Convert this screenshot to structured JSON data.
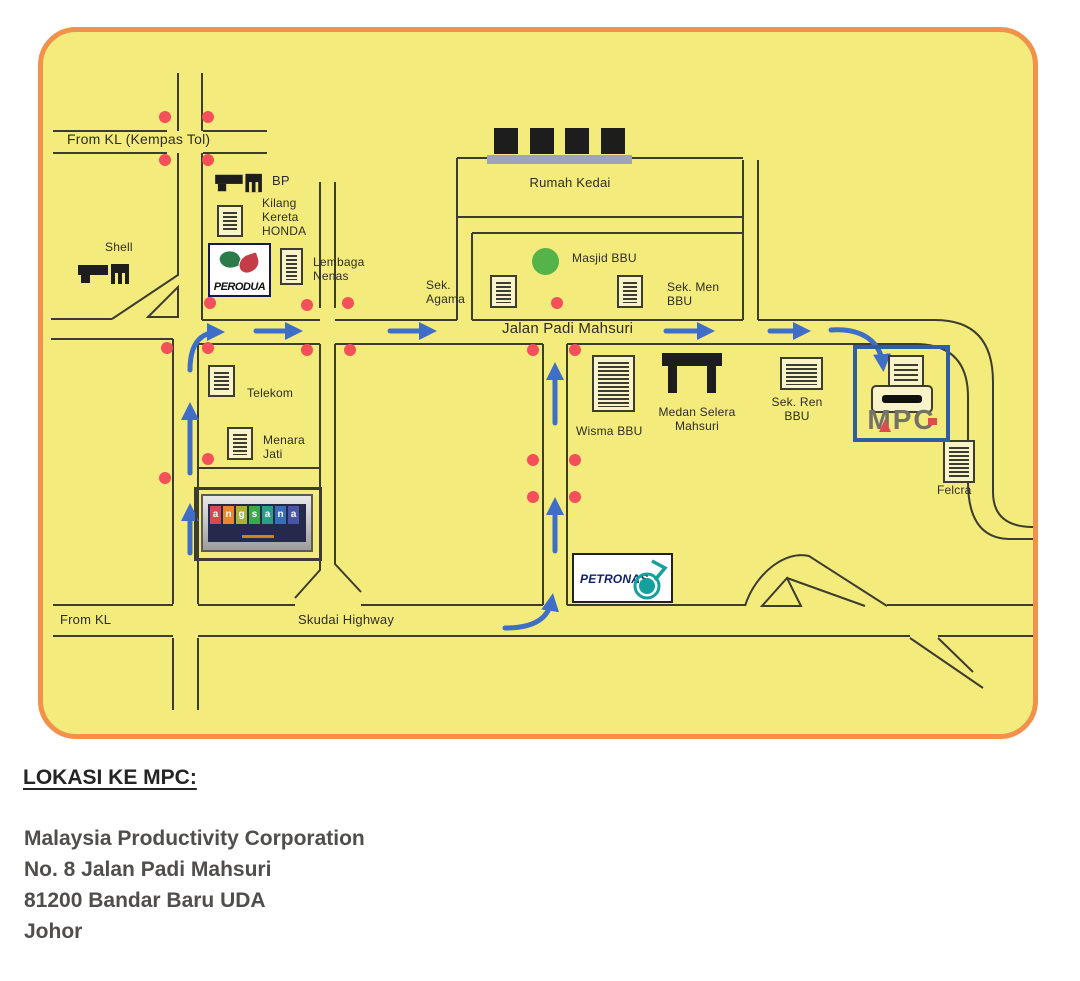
{
  "map": {
    "labels": {
      "from_kl_tol": "From KL (Kempas Tol)",
      "bp": "BP",
      "kilang_kereta_honda": "Kilang\nKereta\nHONDA",
      "shell": "Shell",
      "lembaga_nenas": "Lembaga\nNenas",
      "sek_agama": "Sek.\nAgama",
      "rumah_kedai": "Rumah Kedai",
      "masjid_bbu": "Masjid BBU",
      "sek_men_bbu": "Sek. Men\nBBU",
      "jalan_padi_mahsuri": "Jalan Padi Mahsuri",
      "telekom": "Telekom",
      "menara_jati": "Menara\nJati",
      "wisma_bbu": "Wisma BBU",
      "medan_selera_mahsuri": "Medan Selera\nMahsuri",
      "sek_ren_bbu": "Sek. Ren\nBBU",
      "felcra": "Felcra",
      "from_kl": "From KL",
      "skudai_highway": "Skudai Highway"
    },
    "logos": {
      "perodua": "PERODUA",
      "petronas": "PETRONAS",
      "mpc": "MPC",
      "angsana_letters": [
        "a",
        "n",
        "g",
        "s",
        "a",
        "n",
        "a"
      ],
      "angsana_tile_colors": [
        "#d9484f",
        "#e8872f",
        "#aab32f",
        "#3aa94a",
        "#2a9f85",
        "#3a6db8",
        "#4a55a5"
      ]
    },
    "colors": {
      "map_background": "#F4EB7D",
      "map_border": "#F2914B",
      "road_line": "#3d3c30",
      "route_arrow_blue": "#3e6ec7",
      "traffic_dot_red": "#f3505a",
      "masjid_green": "#54B44A",
      "mpc_box_blue": "#2E5FA3",
      "petronas_teal": "#14a19c",
      "perodua_green": "#2c7b4b",
      "perodua_red": "#c43c45",
      "rumah_kedai_bar": "#9EA3BB"
    }
  },
  "footer": {
    "heading": "LOKASI KE MPC:",
    "address_lines": [
      "Malaysia Productivity Corporation",
      "No. 8 Jalan Padi Mahsuri",
      "81200 Bandar Baru UDA",
      "Johor"
    ]
  }
}
